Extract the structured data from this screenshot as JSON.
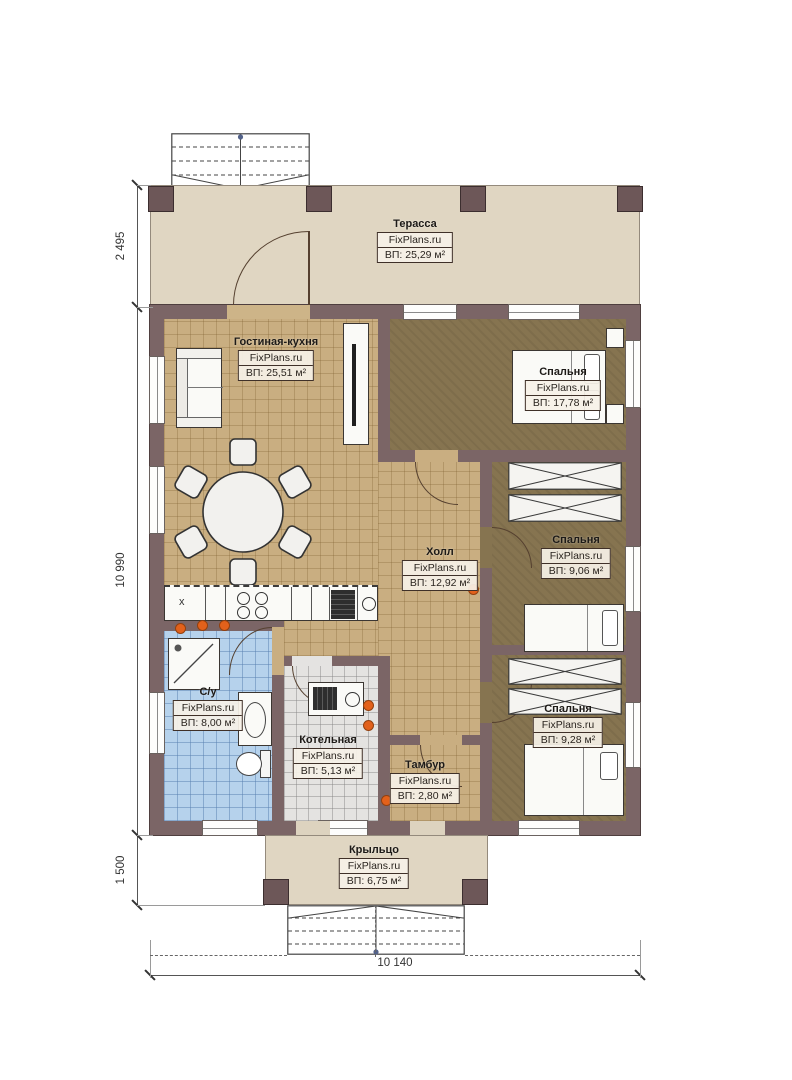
{
  "watermark": "FixPlans.ru",
  "rooms": [
    {
      "name": "Терасса",
      "area": "ВП: 25,29 м²"
    },
    {
      "name": "Гостиная-кухня",
      "area": "ВП: 25,51 м²"
    },
    {
      "name": "Спальня",
      "area": "ВП: 17,78 м²"
    },
    {
      "name": "Холл",
      "area": "ВП: 12,92 м²"
    },
    {
      "name": "Спальня",
      "area": "ВП: 9,06 м²"
    },
    {
      "name": "Спальня",
      "area": "ВП: 9,28 м²"
    },
    {
      "name": "С/у",
      "area": "ВП: 8,00 м²"
    },
    {
      "name": "Котельная",
      "area": "ВП: 5,13 м²"
    },
    {
      "name": "Тамбур",
      "area": "ВП: 2,80 м²"
    },
    {
      "name": "Крыльцо",
      "area": "ВП: 6,75 м²"
    }
  ],
  "dimensions": {
    "terrace_depth": "2 495",
    "house_depth": "10 990",
    "porch_depth": "1 500",
    "total_width": "10 140"
  },
  "symbols": {
    "sink": "х"
  },
  "colors": {
    "wall": "#7b6566",
    "floor_tan": "#c9ae81",
    "floor_dark": "#867450",
    "floor_blue": "#b6d2ec",
    "floor_gray": "#e4e3e1",
    "terrace": "#e0d6c2",
    "radiator": "#e2611b"
  }
}
